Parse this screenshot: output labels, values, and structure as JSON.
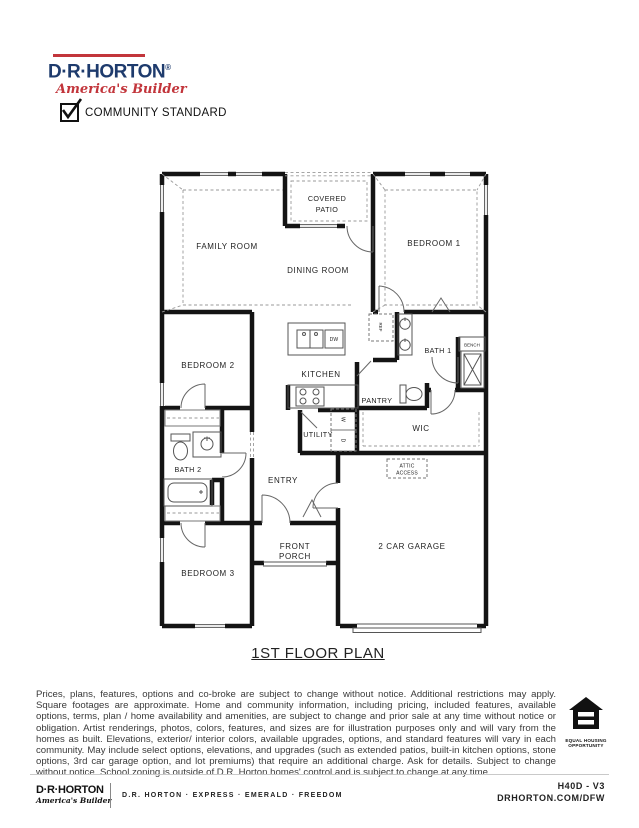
{
  "colors": {
    "brand_navy": "#1e3b6d",
    "brand_red": "#c2353b",
    "wall": "#141414"
  },
  "header": {
    "logo_name": "D·R·HORTON",
    "logo_reg": "®",
    "logo_tagline": "America's Builder",
    "checkbox_label": "COMMUNITY STANDARD",
    "checkbox_checked": true
  },
  "floor_plan": {
    "title": "1ST FLOOR PLAN",
    "labels": {
      "covered_patio_line1": "COVERED",
      "covered_patio_line2": "PATIO",
      "family_room": "FAMILY ROOM",
      "dining_room": "DINING ROOM",
      "bedroom_1": "BEDROOM 1",
      "bedroom_2": "BEDROOM 2",
      "bedroom_3": "BEDROOM 3",
      "kitchen": "KITCHEN",
      "bath_1": "BATH 1",
      "bath_2": "BATH 2",
      "bench": "BENCH",
      "pantry": "PANTRY",
      "wic": "WIC",
      "utility": "UTILITY",
      "entry": "ENTRY",
      "attic_line1": "ATTIC",
      "attic_line2": "ACCESS",
      "front_porch_line1": "FRONT",
      "front_porch_line2": "PORCH",
      "garage": "2 CAR GARAGE",
      "ref": "REF",
      "dw": "DW",
      "washer": "W",
      "dryer": "D"
    }
  },
  "disclaimer": "Prices, plans, features, options and co-broke are subject to change without notice. Additional restrictions may apply.  Square footages are approximate. Home and community information, including pricing, included features, available options, terms, plan / home availability and amenities, are subject to change and prior sale at any time without notice or obligation. Artist renderings, photos, colors, features, and sizes are for illustration purposes only and will vary from the homes as built. Elevations, exterior/ interior colors, available upgrades, options, and standard features will vary in each community. May include select options, elevations, and upgrades (such as extended patios, built-in kitchen options, stone options, 3rd car garage option, and lot premiums) that require an additional charge. Ask for details. Subject to change without notice. School zoning is outside of D.R. Horton homes' control and is subject to change at any time.",
  "eho": {
    "line1": "EQUAL HOUSING",
    "line2": "OPPORTUNITY"
  },
  "footer": {
    "logo_name": "D·R·HORTON",
    "logo_tagline": "America's Builder",
    "brands": "D.R. HORTON · EXPRESS · EMERALD · FREEDOM",
    "plan_code": "H40D - V3",
    "website": "DRHORTON.COM/DFW"
  }
}
